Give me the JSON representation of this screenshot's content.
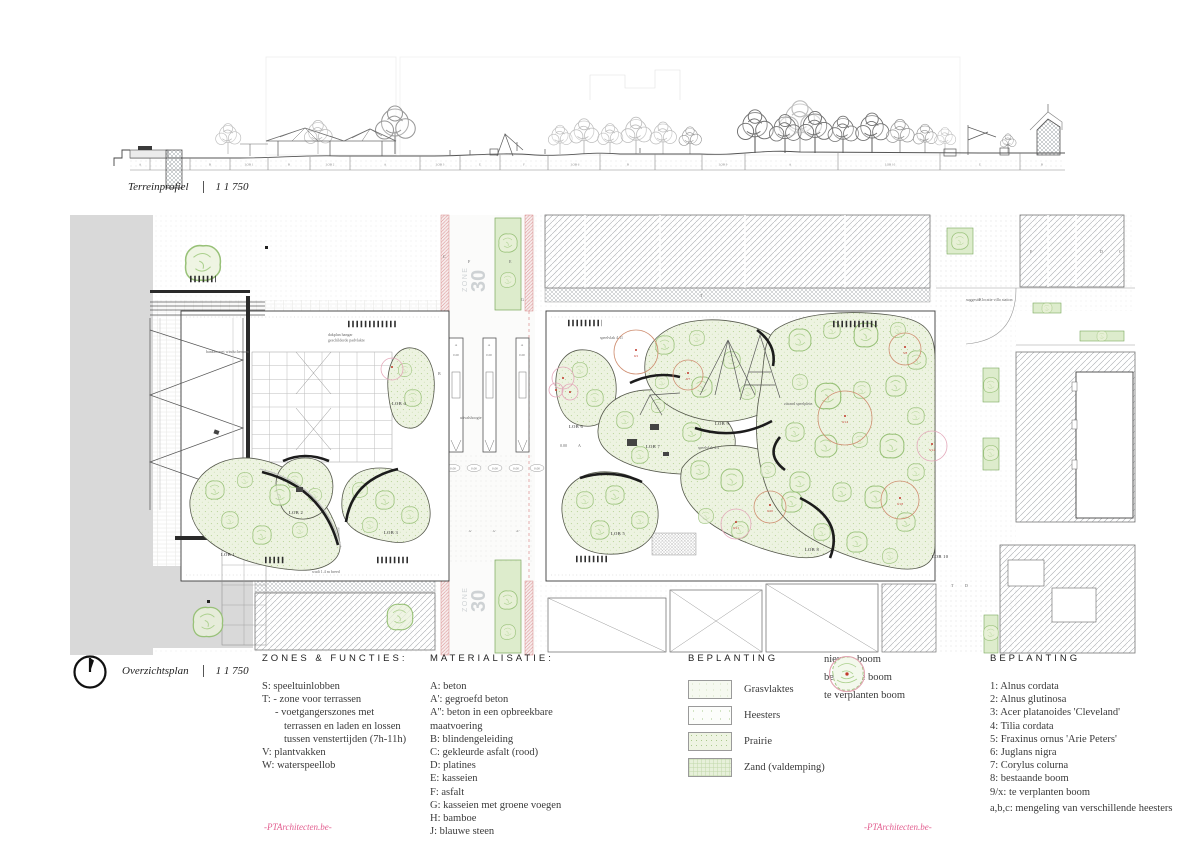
{
  "profile": {
    "title": "Terreinprofiel",
    "scale": "1 1 750",
    "band_labels": [
      "A",
      "J",
      "B",
      "LOB 1",
      "B",
      "LOB 2",
      "A",
      "LOB 3",
      "E",
      "F",
      "LOB 6",
      "B",
      "LOB 9",
      "A",
      "LOB 10",
      "E",
      "B"
    ]
  },
  "plan": {
    "title": "Overzichtsplan",
    "scale": "1 1 750",
    "zone_word": "ZONE",
    "zone_num": "30",
    "lobes": [
      "LOB 1",
      "LOB 2",
      "LOB 3",
      "LOB 4",
      "LOB 5",
      "LOB 6",
      "LOB 7",
      "LOB 8",
      "LOB 9",
      "LOB 10"
    ],
    "tree_tags": [
      "9/2",
      "9/7",
      "5/8",
      "9/14",
      "5/14",
      "9/20",
      "9/21",
      "9/18"
    ],
    "level_label": "0.00",
    "planter_label": "A",
    "row_letters": [
      "A''",
      "A'",
      "A'",
      "A''"
    ],
    "surface_letters": [
      "C",
      "F",
      "E",
      "G",
      "T",
      "D",
      "C",
      "F",
      "B",
      "T",
      "D",
      "E"
    ],
    "annotations": [
      "suggestie locatie villo station",
      "banken met windschermen",
      "dakplan hangar",
      "geschilderde padvlakte",
      "uitvalshoogte",
      "zitrand speelplein",
      "speelvlak 4.11",
      "speelvlak 4.4",
      "wadi 1.4 m breed"
    ]
  },
  "legend_zones": {
    "title": "ZONES & FUNCTIES:",
    "items": [
      "S: speeltuinlobben",
      "T: - zone voor terrassen",
      "- voetgangerszones met",
      "terrassen en laden en lossen",
      "tussen venstertijden (7h-11h)",
      "V: plantvakken",
      "W: waterspeellob"
    ]
  },
  "legend_materials": {
    "title": "MATERIALISATIE:",
    "items": [
      "A: beton",
      "A': gegroefd beton",
      "A'': beton in een opbreekbare",
      "maatvoering",
      "B: blindengeleiding",
      "C: gekleurde asfalt (rood)",
      "D: platines",
      "E: kasseien",
      "F: asfalt",
      "G: kasseien met groene voegen",
      "H: bamboe",
      "J: blauwe steen"
    ]
  },
  "legend_planting": {
    "title": "BEPLANTING",
    "swatches": [
      {
        "label": "Grasvlaktes"
      },
      {
        "label": "Heesters"
      },
      {
        "label": "Prairie"
      },
      {
        "label": "Zand (valdemping)"
      }
    ]
  },
  "legend_trees": [
    {
      "label": "nieuwe boom"
    },
    {
      "label": "bestaande boom"
    },
    {
      "label": "te verplanten boom"
    }
  ],
  "legend_planting2": {
    "title": "BEPLANTING",
    "items": [
      "1: Alnus cordata",
      "2: Alnus glutinosa",
      "3: Acer platanoides 'Cleveland'",
      "4: Tilia cordata",
      "5: Fraxinus ornus 'Arie Peters'",
      "6: Juglans nigra",
      "7: Corylus colurna",
      "8: bestaande boom",
      "9/x:  te verplanten boom",
      "a,b,c: mengeling van verschillende heesters"
    ]
  },
  "footer": {
    "credit_left": "-PTArchitecten.be-",
    "credit_right": "-PTArchitecten.be-"
  },
  "colors": {
    "lobe_fill": "#edf3e1",
    "tree_green": "#98c178",
    "existing_tree": "#cf8f72",
    "move_tree": "#e4a9bb",
    "red_accent": "#c0392b",
    "road_pink": "#d98c8c",
    "credit_pink": "#e25c8e"
  }
}
